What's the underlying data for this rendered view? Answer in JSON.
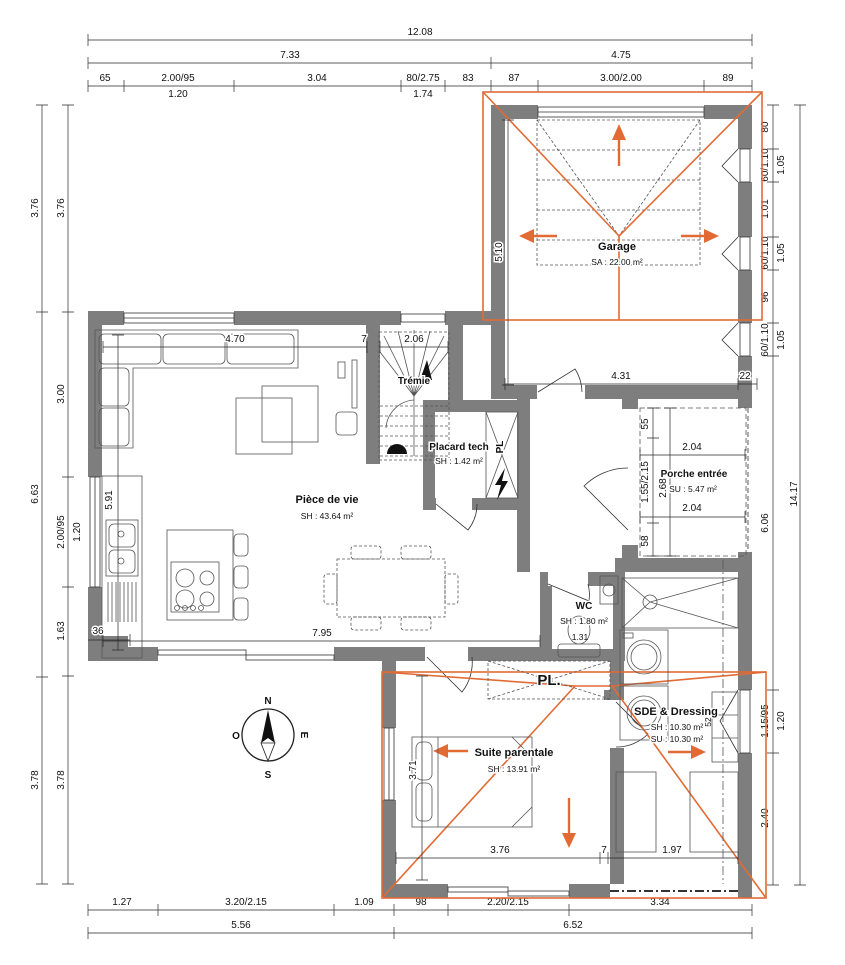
{
  "colors": {
    "wall_gray": "#7e7e7e",
    "roof_orange": "#e26b35",
    "line_dark": "#2a2a2a"
  },
  "compass": {
    "n": "N",
    "e": "E",
    "s": "S",
    "o": "O"
  },
  "rooms": {
    "garage": {
      "name": "Garage",
      "area": "SA : 22.00 m²"
    },
    "living": {
      "name": "Pièce de vie",
      "area": "SH : 43.64 m²"
    },
    "stairs": {
      "name": "Trémie"
    },
    "tech": {
      "name": "Placard tech",
      "area": "SH : 1.42 m²"
    },
    "porch": {
      "name": "Porche entrée",
      "area": "SU : 5.47 m²"
    },
    "wc": {
      "name": "WC",
      "area": "SH : 1.80 m²"
    },
    "sde": {
      "name": "SDE & Dressing",
      "area_sh": "SH : 10.30 m²",
      "area_su": "SU : 10.30 m²"
    },
    "suite": {
      "name": "Suite parentale",
      "area": "SH : 13.91 m²"
    },
    "closet_hall": "PL.",
    "closet_tech": "PL"
  },
  "dims": {
    "top_total": "12.08",
    "top_row2": [
      "7.33",
      "4.75"
    ],
    "top_row3": [
      "65",
      "2.00/95",
      "3.04",
      "80/2.75",
      "83",
      "87",
      "3.00/2.00",
      "89"
    ],
    "top_sub": [
      "1.20",
      "1.74"
    ],
    "left_outer": [
      "3.76",
      "6.63",
      "3.78"
    ],
    "left_inner": [
      "3.76",
      "3.00",
      "2.00/95",
      "1.63",
      "3.78"
    ],
    "left_sub": "1.20",
    "right_outer": "14.17",
    "right_inner": [
      "80",
      "60/1.10",
      "1.01",
      "60/1.10",
      "96",
      "60/1.10",
      "6.06",
      "1.15/95",
      "2.40"
    ],
    "right_sub": [
      "1.05",
      "1.05",
      "1.05",
      "1.20"
    ],
    "bottom_row1": [
      "1.27",
      "3.20/2.15",
      "1.09",
      "98",
      "2.20/2.15",
      "3.34"
    ],
    "bottom_row2": [
      "5.56",
      "6.52"
    ],
    "interior": {
      "living_top": "4.70",
      "living_top_stub": "7",
      "stair_w": "2.06",
      "garage_h": "5.10",
      "garage_w": "4.31",
      "garage_stub": "22",
      "kitchen_h": "5.91",
      "living_w": "7.95",
      "corner_stub": "36",
      "porch_v1": "55",
      "porch_v2": "1.55/2.15",
      "porch_v3": "58",
      "porch_total": "2.68",
      "porch_w1": "2.04",
      "porch_w2": "2.04",
      "bed_h": "3.71",
      "suite_w": "3.76",
      "suite_stub": "7",
      "sde_w": "1.97",
      "wc_w": "1.31",
      "sde_win": "52"
    }
  }
}
